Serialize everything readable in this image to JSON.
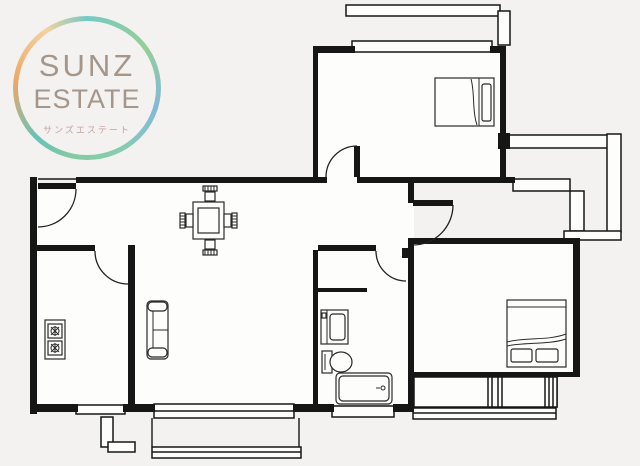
{
  "logo": {
    "title_line1": "SUNZ",
    "title_line2": "ESTATE",
    "subtitle": "サンズエステート",
    "text_color": "#a59689",
    "subtitle_color": "#c7a29b",
    "ring_colors": [
      "#74cac3",
      "#95cf96",
      "#84b8da",
      "#86ccb2",
      "#84cba0",
      "#67c3b8",
      "#eda768",
      "#f3d2a0"
    ]
  },
  "floor_plan": {
    "background_color": "#f3f2f0",
    "wall_color": "#161616",
    "room_fill_color": "#fdfdfc",
    "rooms": [
      {
        "id": "bedroom-upper",
        "furniture": [
          "double-bed"
        ],
        "features": [
          "balcony-top",
          "hinged-door"
        ]
      },
      {
        "id": "living-dining",
        "furniture": [
          "dining-table",
          "four-chairs",
          "sofa"
        ],
        "features": [
          "balcony-bottom",
          "sliding-window"
        ]
      },
      {
        "id": "kitchen",
        "furniture": [
          "two-burner-stove"
        ],
        "features": [
          "window-bottom",
          "hinged-door"
        ]
      },
      {
        "id": "washroom-bath",
        "furniture": [
          "washbasin",
          "toilet",
          "bathtub"
        ],
        "features": [
          "window-bottom",
          "hinged-door"
        ]
      },
      {
        "id": "bedroom-lower",
        "furniture": [
          "double-bed"
        ],
        "features": [
          "window-bottom",
          "hinged-door"
        ]
      },
      {
        "id": "entrance-hall",
        "furniture": [],
        "features": [
          "entry-door"
        ]
      }
    ],
    "exterior_features": [
      "balcony-top",
      "service-balcony-right",
      "balcony-bottom",
      "utility-corner-bottom-left"
    ]
  }
}
